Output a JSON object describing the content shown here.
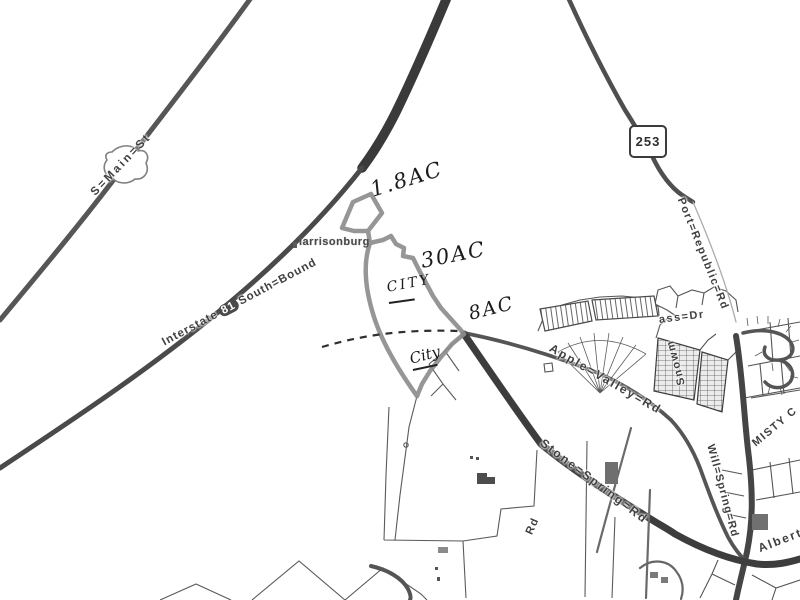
{
  "colors": {
    "background": "#ffffff",
    "road_dark": "#3d3d3d",
    "road": "#4f4f4f",
    "parcel_line": "#5a5a5a",
    "subject_outline": "#8e8e8e",
    "handwriting": "#1b1b1b",
    "label_ink": "#3f3f3f"
  },
  "shields": {
    "route_253": "253"
  },
  "roads": {
    "s_main_st": "S=Main=St",
    "interstate_81": {
      "name": "Interstate",
      "number": "81",
      "direction": "South=Bound"
    },
    "port_republic_rd": "Port=Republic=Rd",
    "apple_valley_rd": "Apple=Valley=Rd",
    "snowmass_dr": {
      "part_vertical": "Snowm",
      "part_horizontal": "ass=Dr"
    },
    "stone_spring_rd": "Stone=Spring=Rd",
    "will_spring_rd": "Will=Spring=Rd",
    "albert_rd": "Albert",
    "misty_ct": "Misty C",
    "rd_fragment": "Rd"
  },
  "places": {
    "city_label": "larrisonburg"
  },
  "annotations": {
    "acreage_small_parcel": "1.8AC",
    "acreage_main_parcel": "30AC",
    "acreage_lower_parcel": "8AC",
    "city_note_upper": "CITY",
    "city_note_lower": "City"
  }
}
